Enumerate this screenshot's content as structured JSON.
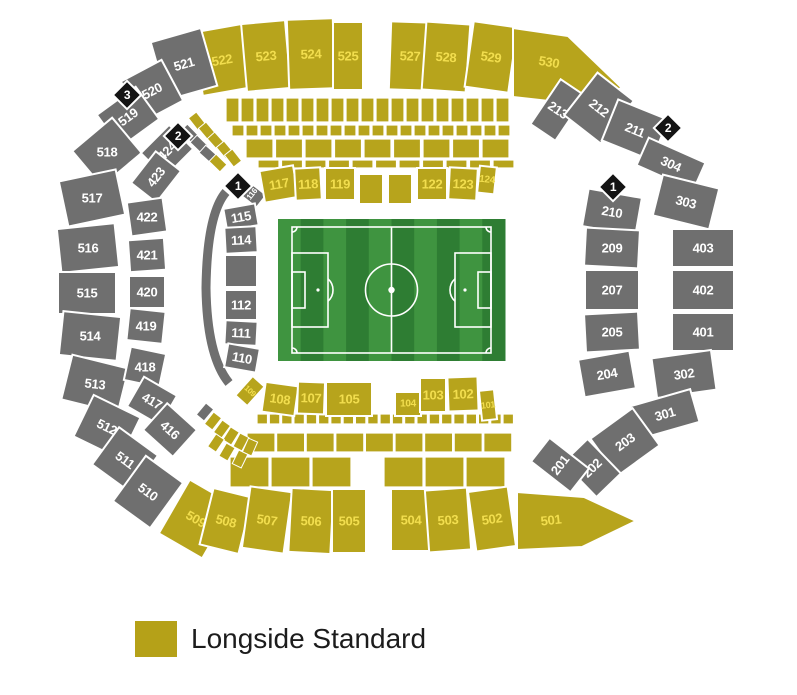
{
  "legend": {
    "label": "Longside Standard",
    "swatch_color": "#B5A118"
  },
  "colors": {
    "standard": "#B7A41C",
    "standard_text": "#F2DE4E",
    "unavailable": "#6F6F6F",
    "unavailable_text": "#FFFFFF",
    "entrance": "#141414",
    "entrance_text": "#FFFFFF",
    "divider": "#FFFFFF",
    "pitch_light": "#3F9440",
    "pitch_dark": "#2E7D33",
    "pitch_line": "#FFFFFF"
  },
  "pitch": {
    "x": 278,
    "y": 219,
    "w": 227,
    "h": 142,
    "stripes": 10
  },
  "entrances": [
    {
      "n": "3",
      "x": 127,
      "y": 95
    },
    {
      "n": "2",
      "x": 178,
      "y": 136
    },
    {
      "n": "1",
      "x": 238,
      "y": 186
    },
    {
      "n": "2",
      "x": 668,
      "y": 128
    },
    {
      "n": "1",
      "x": 613,
      "y": 187
    }
  ],
  "sections": [
    {
      "l": "522",
      "x": 222,
      "y": 60,
      "w": 50,
      "h": 64,
      "r": -10,
      "t": "s"
    },
    {
      "l": "523",
      "x": 266,
      "y": 56,
      "w": 44,
      "h": 68,
      "r": -5,
      "t": "s"
    },
    {
      "l": "524",
      "x": 311,
      "y": 54,
      "w": 46,
      "h": 70,
      "r": -2,
      "t": "s"
    },
    {
      "l": "525",
      "x": 348,
      "y": 56,
      "w": 30,
      "h": 68,
      "r": 0,
      "t": "s"
    },
    {
      "l": "527",
      "x": 410,
      "y": 56,
      "w": 40,
      "h": 68,
      "r": 2,
      "t": "s"
    },
    {
      "l": "528",
      "x": 446,
      "y": 57,
      "w": 44,
      "h": 68,
      "r": 4,
      "t": "s"
    },
    {
      "l": "529",
      "x": 491,
      "y": 57,
      "w": 44,
      "h": 66,
      "r": 8,
      "t": "s"
    },
    {
      "l": "530",
      "x": 549,
      "y": 62,
      "t": "s",
      "lr": 10,
      "pts": [
        [
          513,
          28
        ],
        [
          568,
          36
        ],
        [
          622,
          88
        ],
        [
          576,
          104
        ],
        [
          513,
          97
        ]
      ]
    },
    {
      "l": "521",
      "x": 184,
      "y": 64,
      "w": 52,
      "h": 60,
      "r": -16,
      "t": "u"
    },
    {
      "l": "520",
      "x": 152,
      "y": 91,
      "w": 46,
      "h": 46,
      "r": -28,
      "t": "u"
    },
    {
      "l": "519",
      "x": 128,
      "y": 117,
      "w": 48,
      "h": 40,
      "r": -36,
      "t": "u"
    },
    {
      "l": "518",
      "x": 107,
      "y": 152,
      "w": 52,
      "h": 46,
      "r": -40,
      "t": "u",
      "lr": 0
    },
    {
      "l": "517",
      "x": 92,
      "y": 198,
      "w": 58,
      "h": 46,
      "r": -12,
      "t": "u",
      "lr": 0
    },
    {
      "l": "516",
      "x": 88,
      "y": 248,
      "w": 58,
      "h": 44,
      "r": -6,
      "t": "u",
      "lr": 0
    },
    {
      "l": "515",
      "x": 87,
      "y": 293,
      "w": 58,
      "h": 42,
      "r": 0,
      "t": "u"
    },
    {
      "l": "514",
      "x": 90,
      "y": 336,
      "w": 58,
      "h": 44,
      "r": 6,
      "t": "u",
      "lr": 0
    },
    {
      "l": "513",
      "x": 95,
      "y": 384,
      "w": 58,
      "h": 46,
      "r": 14,
      "t": "u",
      "lr": 6
    },
    {
      "l": "512",
      "x": 107,
      "y": 427,
      "w": 52,
      "h": 46,
      "r": 26,
      "t": "u"
    },
    {
      "l": "511",
      "x": 125,
      "y": 460,
      "w": 48,
      "h": 46,
      "r": 36,
      "t": "u"
    },
    {
      "l": "510",
      "x": 148,
      "y": 492,
      "w": 46,
      "h": 56,
      "r": 36,
      "t": "u"
    },
    {
      "l": "509",
      "x": 196,
      "y": 519,
      "w": 50,
      "h": 62,
      "r": 30,
      "t": "s"
    },
    {
      "l": "508",
      "x": 226,
      "y": 521,
      "w": 40,
      "h": 58,
      "r": 14,
      "t": "s"
    },
    {
      "l": "507",
      "x": 267,
      "y": 520,
      "w": 42,
      "h": 62,
      "r": 8,
      "t": "s"
    },
    {
      "l": "506",
      "x": 311,
      "y": 521,
      "w": 42,
      "h": 64,
      "r": 3,
      "t": "s"
    },
    {
      "l": "505",
      "x": 349,
      "y": 521,
      "w": 34,
      "h": 64,
      "r": 0,
      "t": "s"
    },
    {
      "l": "504",
      "x": 411,
      "y": 520,
      "w": 40,
      "h": 62,
      "r": 0,
      "t": "s"
    },
    {
      "l": "503",
      "x": 448,
      "y": 520,
      "w": 42,
      "h": 62,
      "r": -4,
      "t": "s"
    },
    {
      "l": "502",
      "x": 492,
      "y": 519,
      "w": 40,
      "h": 60,
      "r": -8,
      "t": "s"
    },
    {
      "l": "501",
      "x": 551,
      "y": 520,
      "t": "s",
      "lr": -6,
      "pts": [
        [
          517,
          492
        ],
        [
          584,
          497
        ],
        [
          636,
          521
        ],
        [
          582,
          547
        ],
        [
          517,
          550
        ]
      ]
    },
    {
      "l": "424",
      "x": 167,
      "y": 151,
      "w": 40,
      "h": 34,
      "r": -45,
      "t": "u"
    },
    {
      "l": "423",
      "x": 156,
      "y": 177,
      "w": 40,
      "h": 32,
      "r": -52,
      "t": "u"
    },
    {
      "l": "422",
      "x": 147,
      "y": 217,
      "w": 36,
      "h": 34,
      "r": -8,
      "t": "u",
      "lr": 0
    },
    {
      "l": "421",
      "x": 147,
      "y": 255,
      "w": 36,
      "h": 32,
      "r": -4,
      "t": "u",
      "lr": 0
    },
    {
      "l": "420",
      "x": 147,
      "y": 292,
      "w": 36,
      "h": 32,
      "r": 0,
      "t": "u"
    },
    {
      "l": "419",
      "x": 146,
      "y": 326,
      "w": 36,
      "h": 32,
      "r": 6,
      "t": "u",
      "lr": 0
    },
    {
      "l": "418",
      "x": 145,
      "y": 367,
      "w": 36,
      "h": 34,
      "r": 12,
      "t": "u",
      "lr": 0
    },
    {
      "l": "417",
      "x": 152,
      "y": 401,
      "w": 38,
      "h": 34,
      "r": 30,
      "t": "u"
    },
    {
      "l": "416",
      "x": 170,
      "y": 430,
      "w": 40,
      "h": 36,
      "r": 42,
      "t": "u"
    },
    {
      "l": "116",
      "x": 252,
      "y": 194,
      "w": 16,
      "h": 24,
      "r": -52,
      "t": "u",
      "fs": 8
    },
    {
      "l": "115",
      "x": 241,
      "y": 217,
      "w": 32,
      "h": 22,
      "r": -10,
      "t": "u"
    },
    {
      "l": "114",
      "x": 241,
      "y": 240,
      "w": 32,
      "h": 26,
      "r": -3,
      "t": "u"
    },
    {
      "l": "",
      "x": 241,
      "y": 271,
      "w": 32,
      "h": 32,
      "r": 0,
      "t": "u"
    },
    {
      "l": "112",
      "x": 241,
      "y": 305,
      "w": 32,
      "h": 30,
      "r": 0,
      "t": "u"
    },
    {
      "l": "111",
      "x": 241,
      "y": 333,
      "w": 32,
      "h": 24,
      "r": 3,
      "t": "u"
    },
    {
      "l": "110",
      "x": 242,
      "y": 358,
      "w": 32,
      "h": 24,
      "r": 10,
      "t": "u"
    },
    {
      "l": "117",
      "x": 279,
      "y": 184,
      "w": 34,
      "h": 32,
      "r": -10,
      "t": "s"
    },
    {
      "l": "118",
      "x": 308,
      "y": 184,
      "w": 26,
      "h": 32,
      "r": -3,
      "t": "s"
    },
    {
      "l": "119",
      "x": 340,
      "y": 184,
      "w": 30,
      "h": 32,
      "r": 0,
      "t": "s"
    },
    {
      "l": "",
      "x": 371,
      "y": 189,
      "w": 24,
      "h": 30,
      "r": 0,
      "t": "s"
    },
    {
      "l": "",
      "x": 400,
      "y": 189,
      "w": 24,
      "h": 30,
      "r": 0,
      "t": "s"
    },
    {
      "l": "122",
      "x": 432,
      "y": 184,
      "w": 30,
      "h": 32,
      "r": 0,
      "t": "s"
    },
    {
      "l": "123",
      "x": 463,
      "y": 184,
      "w": 28,
      "h": 32,
      "r": 3,
      "t": "s"
    },
    {
      "l": "124",
      "x": 487,
      "y": 180,
      "w": 17,
      "h": 27,
      "r": 6,
      "t": "s",
      "fs": 10
    },
    {
      "l": "109",
      "x": 250,
      "y": 391,
      "w": 16,
      "h": 26,
      "r": 42,
      "t": "s",
      "fs": 8
    },
    {
      "l": "108",
      "x": 280,
      "y": 399,
      "w": 33,
      "h": 30,
      "r": 8,
      "t": "s"
    },
    {
      "l": "107",
      "x": 311,
      "y": 398,
      "w": 27,
      "h": 32,
      "r": 2,
      "t": "s"
    },
    {
      "l": "105",
      "x": 349,
      "y": 399,
      "w": 46,
      "h": 34,
      "r": 0,
      "t": "s"
    },
    {
      "l": "104",
      "x": 408,
      "y": 404,
      "w": 26,
      "h": 24,
      "r": 0,
      "t": "s",
      "fs": 10
    },
    {
      "l": "103",
      "x": 433,
      "y": 395,
      "w": 26,
      "h": 34,
      "r": 0,
      "t": "s"
    },
    {
      "l": "102",
      "x": 463,
      "y": 394,
      "w": 30,
      "h": 34,
      "r": -2,
      "t": "s"
    },
    {
      "l": "101",
      "x": 488,
      "y": 405,
      "w": 15,
      "h": 30,
      "r": -6,
      "t": "s",
      "fs": 9
    },
    {
      "l": "213",
      "x": 558,
      "y": 110,
      "w": 30,
      "h": 54,
      "r": 34,
      "t": "u"
    },
    {
      "l": "212",
      "x": 599,
      "y": 108,
      "w": 46,
      "h": 54,
      "r": 38,
      "t": "u"
    },
    {
      "l": "211",
      "x": 635,
      "y": 130,
      "w": 54,
      "h": 44,
      "r": 22,
      "t": "u"
    },
    {
      "l": "304",
      "x": 671,
      "y": 164,
      "w": 62,
      "h": 30,
      "r": 24,
      "t": "u"
    },
    {
      "l": "210",
      "x": 612,
      "y": 212,
      "w": 54,
      "h": 38,
      "r": 10,
      "t": "u"
    },
    {
      "l": "303",
      "x": 686,
      "y": 202,
      "w": 58,
      "h": 42,
      "r": 14,
      "t": "u"
    },
    {
      "l": "209",
      "x": 612,
      "y": 248,
      "w": 54,
      "h": 38,
      "r": 3,
      "t": "u",
      "lr": 0
    },
    {
      "l": "403",
      "x": 703,
      "y": 248,
      "w": 62,
      "h": 38,
      "r": 0,
      "t": "u"
    },
    {
      "l": "207",
      "x": 612,
      "y": 290,
      "w": 54,
      "h": 40,
      "r": 0,
      "t": "u"
    },
    {
      "l": "402",
      "x": 703,
      "y": 290,
      "w": 62,
      "h": 40,
      "r": 0,
      "t": "u"
    },
    {
      "l": "205",
      "x": 612,
      "y": 332,
      "w": 54,
      "h": 38,
      "r": -3,
      "t": "u",
      "lr": 0
    },
    {
      "l": "401",
      "x": 703,
      "y": 332,
      "w": 62,
      "h": 38,
      "r": 0,
      "t": "u"
    },
    {
      "l": "204",
      "x": 607,
      "y": 374,
      "w": 52,
      "h": 38,
      "r": -10,
      "t": "u"
    },
    {
      "l": "302",
      "x": 684,
      "y": 374,
      "w": 60,
      "h": 40,
      "r": -8,
      "t": "u"
    },
    {
      "l": "301",
      "x": 665,
      "y": 414,
      "w": 62,
      "h": 34,
      "r": -16,
      "t": "u"
    },
    {
      "l": "203",
      "x": 625,
      "y": 442,
      "w": 52,
      "h": 46,
      "r": -36,
      "t": "u"
    },
    {
      "l": "202",
      "x": 592,
      "y": 468,
      "w": 34,
      "h": 48,
      "r": -44,
      "t": "u"
    },
    {
      "l": "201",
      "x": 560,
      "y": 465,
      "w": 30,
      "h": 50,
      "r": -52,
      "t": "u"
    }
  ],
  "filler_rows": [
    {
      "x": 226,
      "y": 98,
      "w": 13,
      "h": 24,
      "n": 19,
      "g": 2
    },
    {
      "x": 232,
      "y": 125,
      "w": 12,
      "h": 11,
      "n": 20,
      "g": 2
    },
    {
      "x": 246,
      "y": 139,
      "w": 27,
      "h": 19,
      "n": 9,
      "g": 2.5
    },
    {
      "x": 258,
      "y": 160,
      "w": 21,
      "h": 8,
      "n": 11,
      "g": 2.5
    },
    {
      "x": 257,
      "y": 414,
      "w": 10.5,
      "h": 10,
      "n": 21,
      "g": 1.8
    },
    {
      "x": 247,
      "y": 433,
      "w": 28,
      "h": 19,
      "n": 9,
      "g": 1.6
    },
    {
      "x": 230,
      "y": 457,
      "w": 39,
      "h": 30,
      "n": 3,
      "g": 2
    },
    {
      "x": 384,
      "y": 457,
      "w": 39,
      "h": 30,
      "n": 3,
      "g": 2
    }
  ],
  "filler_rot": [
    {
      "x": 197,
      "y": 121,
      "r": -38
    },
    {
      "x": 189,
      "y": 133,
      "r": -44,
      "t": "u"
    },
    {
      "x": 207,
      "y": 131,
      "r": -40
    },
    {
      "x": 199,
      "y": 144,
      "r": -46,
      "t": "u"
    },
    {
      "x": 216,
      "y": 141,
      "r": -42
    },
    {
      "x": 208,
      "y": 154,
      "r": -48,
      "t": "u"
    },
    {
      "x": 225,
      "y": 150,
      "r": -40
    },
    {
      "x": 218,
      "y": 163,
      "r": -46
    },
    {
      "x": 233,
      "y": 158,
      "r": -38
    },
    {
      "x": 205,
      "y": 412,
      "r": 40,
      "t": "u"
    },
    {
      "x": 213,
      "y": 421,
      "r": 38
    },
    {
      "x": 222,
      "y": 429,
      "r": 36
    },
    {
      "x": 231,
      "y": 436,
      "r": 32
    },
    {
      "x": 241,
      "y": 442,
      "r": 28
    },
    {
      "x": 250,
      "y": 447,
      "r": 24
    },
    {
      "x": 216,
      "y": 443,
      "r": 34
    },
    {
      "x": 227,
      "y": 452,
      "r": 30
    },
    {
      "x": 240,
      "y": 459,
      "r": 26
    }
  ]
}
